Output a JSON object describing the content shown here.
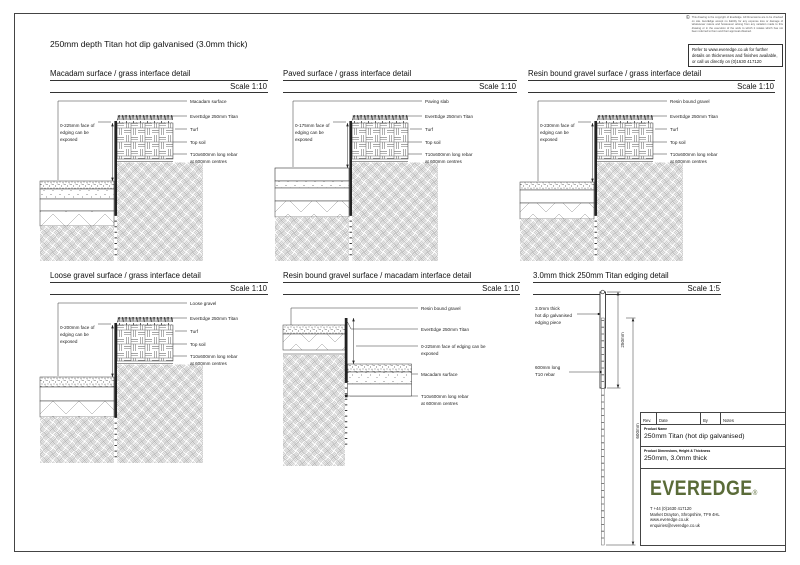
{
  "sheet": {
    "main_title": "250mm depth Titan hot dip galvanised (3.0mm thick)",
    "copyright_symbol": "©",
    "copyright_note": "This drawing is the copyright of EverEdge. All Dimensions are to be checked on site. EverEdge accept no liability for any expense loss or damage of whatsoever nature and howsoever arising from any variation made to this drawing or in the execution of the work to which it relates which has not been referred to them and their approval obtained.",
    "refer_note": "Refer to www.everedge.co.uk for further details on thicknesses and finishes available, or call us directly on (0)1630 417120"
  },
  "labels": {
    "everedge": "EverEdge 250mm Titan",
    "turf": "Turf",
    "top_soil": "Top soil",
    "rebar_1": "T10x600mm long rebar",
    "rebar_2": "at 600mm centres",
    "exposed_2": "edging can be",
    "exposed_3": "exposed"
  },
  "panels": [
    {
      "title": "Macadam surface / grass interface detail",
      "scale": "Scale 1:10",
      "surface": "Macadam surface",
      "exposed_1": "0-225mm face of"
    },
    {
      "title": "Paved surface / grass interface detail",
      "scale": "Scale 1:10",
      "surface": "Paving slab",
      "exposed_1": "0-175mm face of"
    },
    {
      "title": "Resin bound gravel surface / grass interface detail",
      "scale": "Scale 1:10",
      "surface": "Resin bound gravel",
      "exposed_1": "0-230mm face of"
    },
    {
      "title": "Loose gravel surface / grass interface detail",
      "scale": "Scale 1:10",
      "surface": "Loose gravel",
      "exposed_1": "0-200mm face of"
    },
    {
      "title": "Resin bound gravel surface / macadam interface detail",
      "scale": "Scale 1:10",
      "surface": "Resin bound gravel",
      "surface2": "Macadam surface",
      "exposed_1": "0-225mm face of edging can be",
      "exposed_2": "exposed"
    },
    {
      "title": "3.0mm thick 250mm Titan edging detail",
      "scale": "Scale 1:5",
      "edge_label_1": "3.0mm thick",
      "edge_label_2": "hot dip galvanised",
      "edge_label_3": "edging piece",
      "rebar_label_1": "600mm long",
      "rebar_label_2": "T10 rebar",
      "dim_250": "250mm",
      "dim_600": "600mm"
    }
  ],
  "title_block": {
    "rev": "Rev.",
    "date": "Date",
    "by": "By",
    "notes": "Notes",
    "product_name_label": "Product Name",
    "product_name": "250mm Titan (hot dip galvanised)",
    "product_dims_label": "Product Dimensions, Height & Thickness",
    "product_dims": "250mm, 3.0mm thick",
    "logo_text": "EVEREDGE",
    "registered_mark": "®",
    "phone": "T +44 (0)1630 417120",
    "address": "Market Drayton, Shropshire, TF9 4HL",
    "website": "www.everedge.co.uk",
    "email": "enquiries@everedge.co.uk",
    "logo_color": "#5a6b38"
  }
}
